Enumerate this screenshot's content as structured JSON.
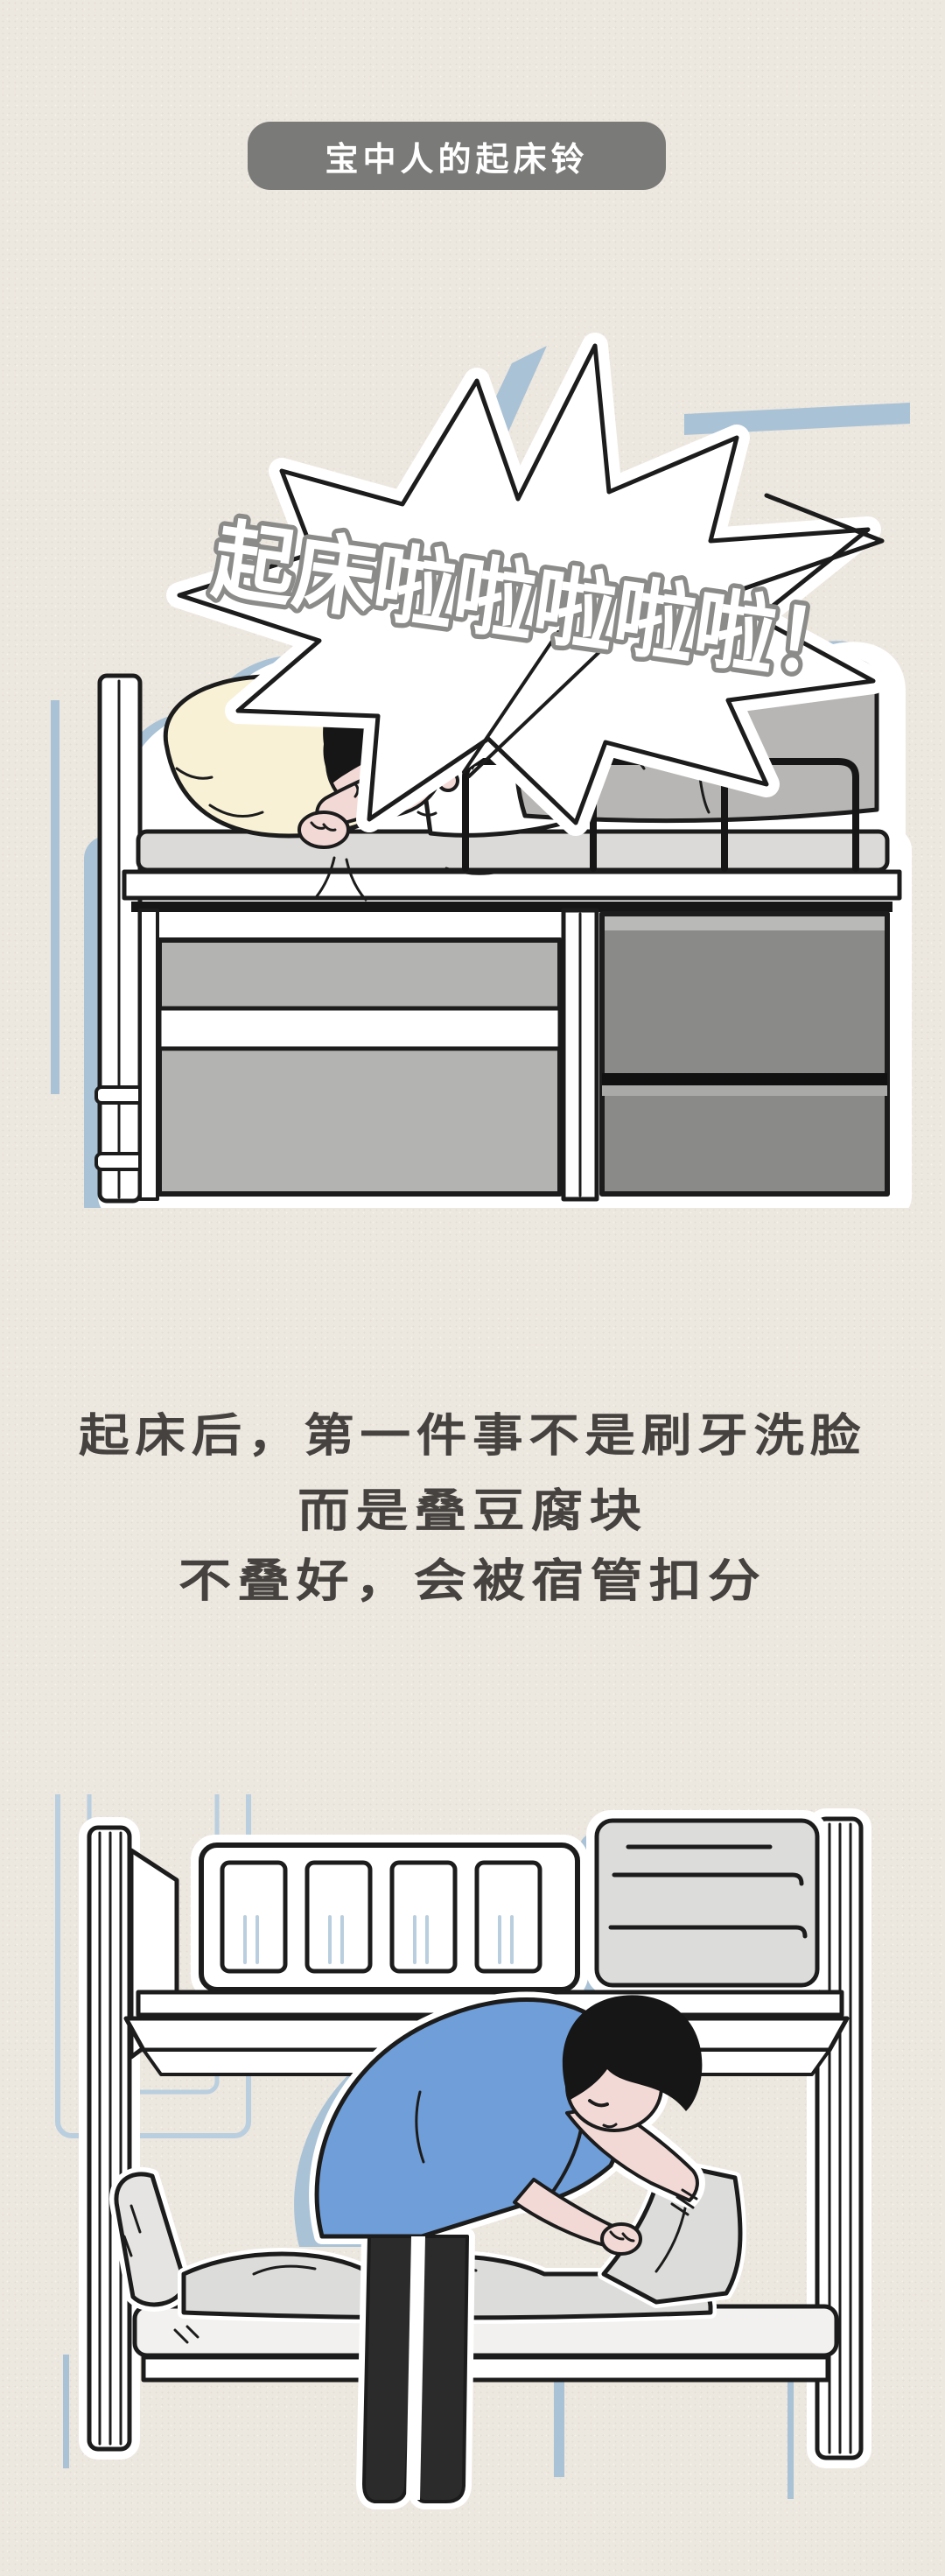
{
  "header": {
    "badge_label": "宝中人的起床铃"
  },
  "comic_top": {
    "bubble_text": "起床啦啦啦啦啦！"
  },
  "caption": {
    "line1": "起床后，第一件事不是刷牙洗脸",
    "line2": "而是叠豆腐块",
    "line3": "不叠好，会被宿管扣分"
  },
  "colors": {
    "page_bg": "#ece7df",
    "badge_bg": "#7a7a78",
    "badge_text": "#ffffff",
    "caption_text": "#45423f",
    "accent_blue": "#a9c2d6",
    "outline": "#1c1c1c",
    "bubble_fill": "#ffffff",
    "bubble_text_fill": "#ffffff",
    "bubble_text_stroke": "#8b8b89",
    "blanket_gray": "#b7b6b4",
    "mattress_gray": "#dbdad8",
    "panel_left_gray": "#b3b3b1",
    "panel_right_gray": "#8a8a88",
    "skin": "#f3d9d5",
    "pillow_cream": "#f8f1d6",
    "hair_black": "#161616",
    "shirt_blue": "#6f9ed8",
    "pants_black": "#2b2b2b",
    "quilt_gray": "#dcdcdb"
  }
}
